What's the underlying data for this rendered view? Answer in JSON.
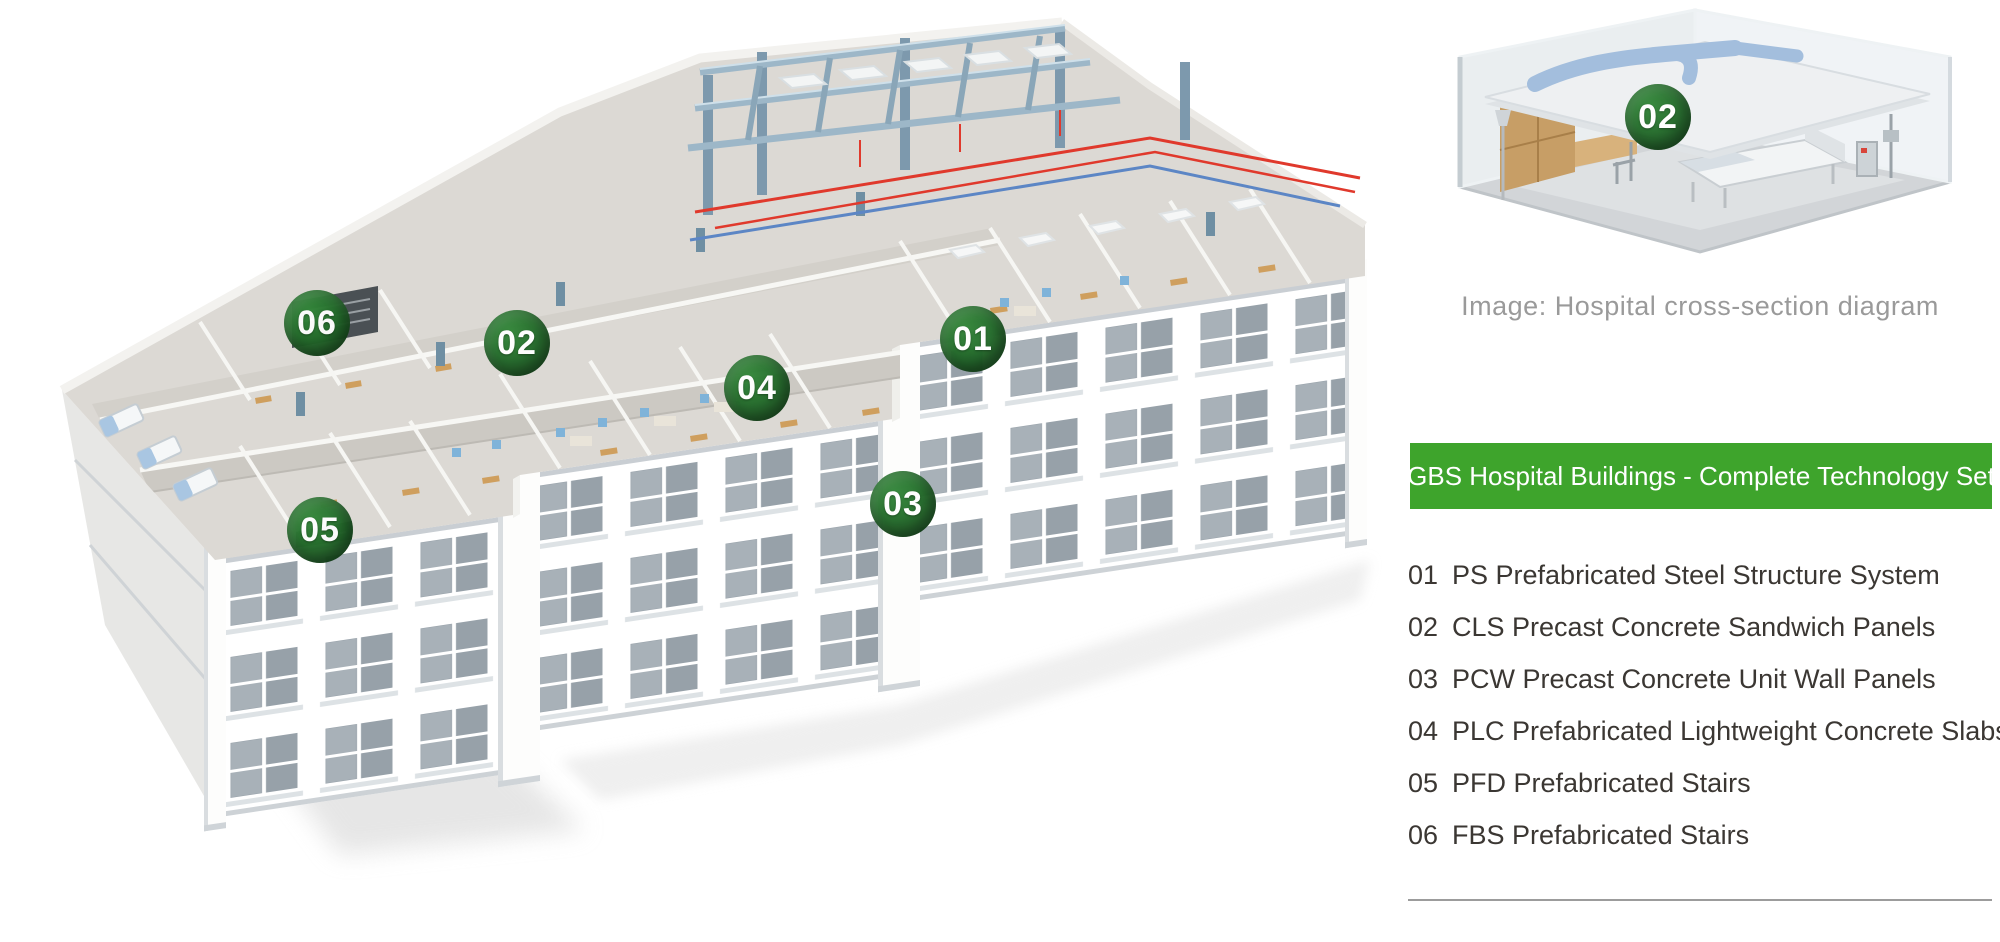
{
  "main_diagram": {
    "markers": [
      {
        "label": "01"
      },
      {
        "label": "02"
      },
      {
        "label": "03"
      },
      {
        "label": "04"
      },
      {
        "label": "05"
      },
      {
        "label": "06"
      }
    ]
  },
  "side_image": {
    "marker_label": "02",
    "caption": "Image: Hospital cross-section diagram"
  },
  "banner": {
    "title": "GBS Hospital Buildings - Complete Technology Set"
  },
  "legend": {
    "items": [
      {
        "num": "01",
        "label": "PS Prefabricated Steel Structure System"
      },
      {
        "num": "02",
        "label": "CLS Precast Concrete Sandwich Panels"
      },
      {
        "num": "03",
        "label": "PCW Precast Concrete Unit Wall Panels"
      },
      {
        "num": "04",
        "label": "PLC Prefabricated Lightweight Concrete Slabs"
      },
      {
        "num": "05",
        "label": "PFD Prefabricated Stairs"
      },
      {
        "num": "06",
        "label": "FBS Prefabricated Stairs"
      }
    ]
  },
  "colors": {
    "banner_green": "#3ea42c",
    "badge_green_light": "#2f7f33",
    "badge_green_dark": "#154d1d",
    "steel_blue": "#9db7c8",
    "pipe_red": "#e0392c",
    "duct_blue": "#a3bedd",
    "window_gray": "#97a1a9",
    "wood_tan": "#cf9f5e",
    "caption_gray": "#9a9a9a"
  }
}
